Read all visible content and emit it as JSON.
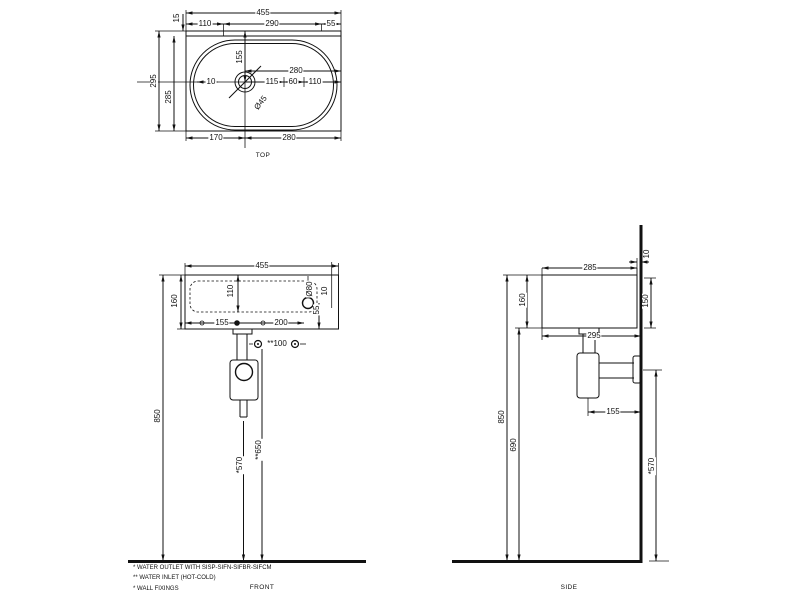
{
  "colors": {
    "line": "#111111",
    "background": "#ffffff"
  },
  "drawing_type": "washbasin-dimension-drawing",
  "units": "mm",
  "views": [
    {
      "id": "top",
      "title": "TOP",
      "title_pos": {
        "x": 263,
        "y": 156
      },
      "labels": [
        {
          "t": "455",
          "x": 263,
          "y": 13
        },
        {
          "t": "15",
          "x": 177,
          "y": 18,
          "r": -90
        },
        {
          "t": "110",
          "x": 205,
          "y": 24
        },
        {
          "t": "290",
          "x": 272,
          "y": 24
        },
        {
          "t": "55",
          "x": 331,
          "y": 24
        },
        {
          "t": "295",
          "x": 154,
          "y": 81,
          "r": -90
        },
        {
          "t": "285",
          "x": 169,
          "y": 97,
          "r": -90
        },
        {
          "t": "10",
          "x": 211,
          "y": 82
        },
        {
          "t": "155",
          "x": 240,
          "y": 57,
          "r": -90
        },
        {
          "t": "280",
          "x": 296,
          "y": 71
        },
        {
          "t": "115",
          "x": 272,
          "y": 82
        },
        {
          "t": "60",
          "x": 293,
          "y": 82
        },
        {
          "t": "110",
          "x": 315,
          "y": 82
        },
        {
          "t": "Ø45",
          "x": 261,
          "y": 103,
          "r": -52
        },
        {
          "t": "170",
          "x": 216,
          "y": 138
        },
        {
          "t": "280",
          "x": 289,
          "y": 138
        }
      ]
    },
    {
      "id": "front",
      "title": "FRONT",
      "title_pos": {
        "x": 262,
        "y": 588
      },
      "labels": [
        {
          "t": "455",
          "x": 262,
          "y": 266
        },
        {
          "t": "160",
          "x": 175,
          "y": 301,
          "r": -90
        },
        {
          "t": "110",
          "x": 231,
          "y": 291,
          "r": -90
        },
        {
          "t": "Ø80",
          "x": 310,
          "y": 289,
          "r": -90
        },
        {
          "t": "55",
          "x": 317,
          "y": 310,
          "r": -90
        },
        {
          "t": "10",
          "x": 325,
          "y": 291,
          "r": -90
        },
        {
          "t": "155",
          "x": 222,
          "y": 323
        },
        {
          "t": "200",
          "x": 281,
          "y": 323
        },
        {
          "t": "**100",
          "x": 277,
          "y": 344
        },
        {
          "t": "850",
          "x": 158,
          "y": 416,
          "r": -90
        },
        {
          "t": "*570",
          "x": 240,
          "y": 465,
          "r": -90
        },
        {
          "t": "**650",
          "x": 259,
          "y": 450,
          "r": -90
        }
      ]
    },
    {
      "id": "side",
      "title": "SIDE",
      "title_pos": {
        "x": 569,
        "y": 588
      },
      "labels": [
        {
          "t": "285",
          "x": 590,
          "y": 268
        },
        {
          "t": "10",
          "x": 647,
          "y": 254,
          "r": -90
        },
        {
          "t": "150",
          "x": 646,
          "y": 301,
          "r": -90
        },
        {
          "t": "160",
          "x": 523,
          "y": 300,
          "r": -90
        },
        {
          "t": "295",
          "x": 594,
          "y": 336
        },
        {
          "t": "850",
          "x": 502,
          "y": 417,
          "r": -90
        },
        {
          "t": "690",
          "x": 514,
          "y": 445,
          "r": -90
        },
        {
          "t": "155",
          "x": 613,
          "y": 412
        },
        {
          "t": "*570",
          "x": 652,
          "y": 466,
          "r": -90
        }
      ]
    }
  ],
  "footnotes": [
    {
      "t": "*  WATER OUTLET WITH SISP-SIFN-SIFBR-SIFCM",
      "x": 133,
      "y": 568
    },
    {
      "t": "** WATER INLET  (HOT-COLD)",
      "x": 133,
      "y": 578
    },
    {
      "t": "*  WALL FIXINGS",
      "x": 133,
      "y": 589
    }
  ]
}
